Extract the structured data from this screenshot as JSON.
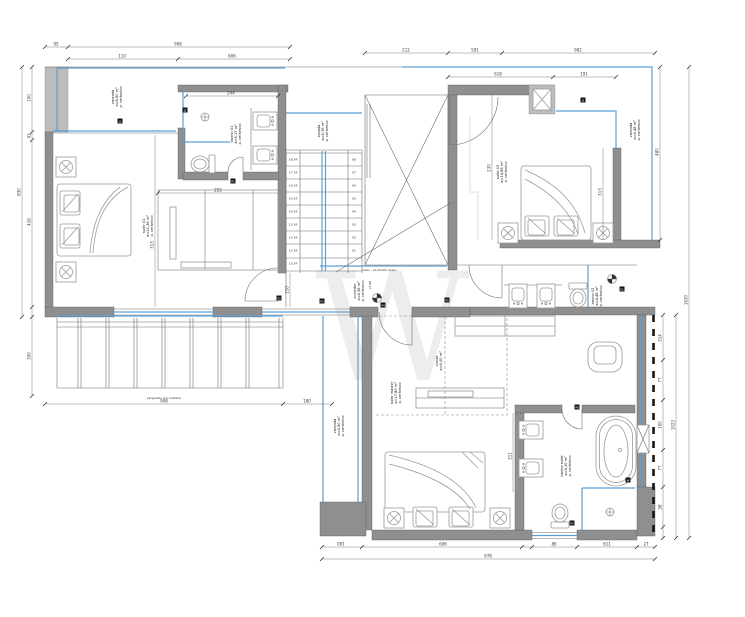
{
  "colors": {
    "accent_blue": "#5b9fd4",
    "wall_gray": "#8f8f8f",
    "wall_light": "#bcbcbc",
    "paper": "#ffffff"
  },
  "rooms": {
    "varanda_frontal": [
      "varanda",
      "a=8,50 m²",
      "p. cerâmico"
    ],
    "suite01": [
      "suíte 01",
      "a=21,36 m²",
      "p. cerâmico"
    ],
    "banho01": [
      "banho 01",
      "a=5,17 m²",
      "p. cerâmico"
    ],
    "escada": [
      "escada",
      "a=6,76 m²",
      "p. cerâmico"
    ],
    "varanda_direita": [
      "varanda",
      "a=6,48 m²",
      "p. cerâmico"
    ],
    "suite02": [
      "suíte 02",
      "a=14,85 m²",
      "p. cerâmico"
    ],
    "banho02": [
      "banho 02",
      "a=4,48 m²",
      "p. cerâmico"
    ],
    "corredor": [
      "corredor",
      "a=4,38 m²",
      "p. cerâmico"
    ],
    "closet": [
      "closet",
      "a=6,00 m²"
    ],
    "suite_master": [
      "suíte master",
      "a=17,80 m²",
      "p. cerâmico"
    ],
    "banho_master": [
      "banho suíte",
      "a=6,10 m²",
      "p. cerâmico"
    ],
    "varanda_lateral": [
      "varanda",
      "a=4,50 m²",
      "p. cerâmico"
    ]
  },
  "notes": {
    "pergolado": "pergolado em madeira",
    "vazio": "vazio - pé direito duplo",
    "nivel": "+2,88"
  },
  "stairs": {
    "left": [
      "18 24",
      "17 24",
      "16 24",
      "15 24",
      "14 24",
      "13 24",
      "12 24",
      "11 24",
      "10 24"
    ],
    "right": [
      "08",
      "07",
      "06",
      "05",
      "04",
      "03",
      "02",
      "01"
    ]
  },
  "dims": [
    "95",
    "908",
    "110",
    "606",
    "212",
    "591",
    "982",
    "618",
    "191",
    "244",
    "252",
    "830",
    "100",
    "41",
    "416",
    "300",
    "313",
    "230",
    "313",
    "110",
    "311",
    "480",
    "314",
    "77",
    "100",
    "77",
    "58",
    "1023",
    "1630",
    "908",
    "180",
    "091",
    "606",
    "86",
    "611",
    "27",
    "978"
  ],
  "tags": [
    "J1",
    "J2",
    "P1",
    "P2",
    "P3",
    "P4",
    "P5",
    "J3",
    "P6",
    "P7",
    "J4",
    "E1"
  ],
  "watermark": "W"
}
